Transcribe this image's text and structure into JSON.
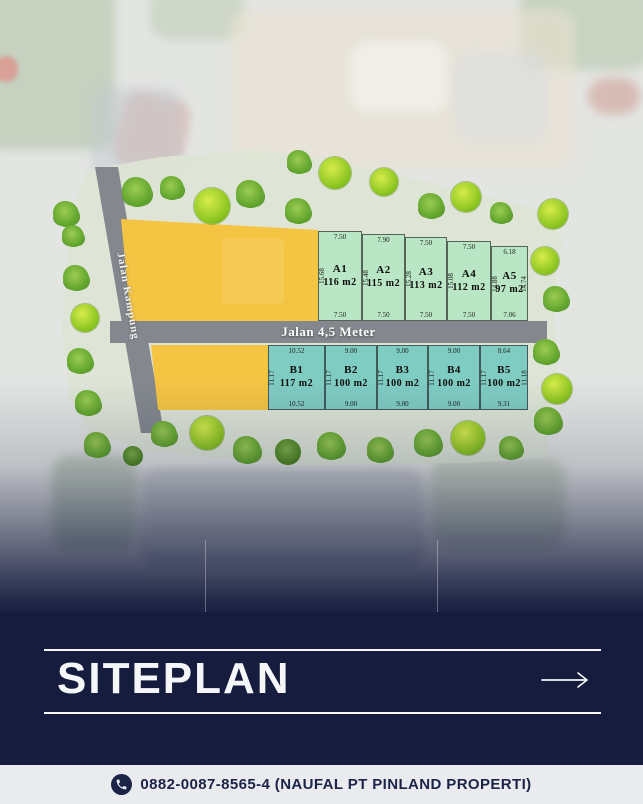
{
  "siteplan": {
    "road_vertical_label": "Jalan Kampung",
    "road_horizontal_label": "Jalan 4,5 Meter",
    "row_a": [
      {
        "id": "A1",
        "area": "116 m2",
        "top": "7.50",
        "bottom": "7.50",
        "side": "15.68"
      },
      {
        "id": "A2",
        "area": "115 m2",
        "top": "7.90",
        "bottom": "7.50",
        "side": "15.48"
      },
      {
        "id": "A3",
        "area": "113 m2",
        "top": "7.50",
        "bottom": "7.50",
        "side": "15.28"
      },
      {
        "id": "A4",
        "area": "112 m2",
        "top": "7.50",
        "bottom": "7.50",
        "side": "15.08"
      },
      {
        "id": "A5",
        "area": "97 m2",
        "top": "6.18",
        "bottom": "7.06",
        "side": "14.88",
        "side_right": "14.74"
      }
    ],
    "row_b": [
      {
        "id": "B1",
        "area": "117 m2",
        "top": "10.52",
        "bottom": "10.52",
        "side": "11.17"
      },
      {
        "id": "B2",
        "area": "100 m2",
        "top": "9.00",
        "bottom": "9.00",
        "side": "11.17"
      },
      {
        "id": "B3",
        "area": "100 m2",
        "top": "9.00",
        "bottom": "9.00",
        "side": "11.17"
      },
      {
        "id": "B4",
        "area": "100 m2",
        "top": "9.00",
        "bottom": "9.00",
        "side": "11.17"
      },
      {
        "id": "B5",
        "area": "100 m2",
        "top": "8.64",
        "bottom": "9.31",
        "side": "11.17",
        "side_right": "11.18"
      }
    ],
    "trees": [
      {
        "x": 66,
        "y": 214,
        "d": 26,
        "v": "m"
      },
      {
        "x": 137,
        "y": 192,
        "d": 30,
        "v": "m"
      },
      {
        "x": 172,
        "y": 188,
        "d": 24,
        "v": "m"
      },
      {
        "x": 212,
        "y": 206,
        "d": 36,
        "v": "b"
      },
      {
        "x": 250,
        "y": 194,
        "d": 28,
        "v": "m"
      },
      {
        "x": 299,
        "y": 162,
        "d": 24,
        "v": "m"
      },
      {
        "x": 298,
        "y": 211,
        "d": 26,
        "v": "m"
      },
      {
        "x": 335,
        "y": 173,
        "d": 32,
        "v": "b"
      },
      {
        "x": 384,
        "y": 182,
        "d": 28,
        "v": "b"
      },
      {
        "x": 431,
        "y": 206,
        "d": 26,
        "v": "m"
      },
      {
        "x": 466,
        "y": 197,
        "d": 30,
        "v": "b"
      },
      {
        "x": 501,
        "y": 213,
        "d": 22,
        "v": "m"
      },
      {
        "x": 553,
        "y": 214,
        "d": 30,
        "v": "b"
      },
      {
        "x": 545,
        "y": 261,
        "d": 28,
        "v": "b"
      },
      {
        "x": 556,
        "y": 299,
        "d": 26,
        "v": "m"
      },
      {
        "x": 546,
        "y": 352,
        "d": 26,
        "v": "m"
      },
      {
        "x": 557,
        "y": 389,
        "d": 30,
        "v": "b"
      },
      {
        "x": 97,
        "y": 445,
        "d": 26,
        "v": "m"
      },
      {
        "x": 133,
        "y": 456,
        "d": 20,
        "v": "k"
      },
      {
        "x": 164,
        "y": 434,
        "d": 26,
        "v": "m"
      },
      {
        "x": 207,
        "y": 433,
        "d": 34,
        "v": "b"
      },
      {
        "x": 247,
        "y": 450,
        "d": 28,
        "v": "m"
      },
      {
        "x": 288,
        "y": 452,
        "d": 26,
        "v": "k"
      },
      {
        "x": 331,
        "y": 446,
        "d": 28,
        "v": "m"
      },
      {
        "x": 380,
        "y": 450,
        "d": 26,
        "v": "m"
      },
      {
        "x": 428,
        "y": 443,
        "d": 28,
        "v": "m"
      },
      {
        "x": 468,
        "y": 438,
        "d": 34,
        "v": "b"
      },
      {
        "x": 511,
        "y": 448,
        "d": 24,
        "v": "m"
      },
      {
        "x": 548,
        "y": 421,
        "d": 28,
        "v": "m"
      },
      {
        "x": 73,
        "y": 236,
        "d": 22,
        "v": "m"
      },
      {
        "x": 76,
        "y": 278,
        "d": 26,
        "v": "m"
      },
      {
        "x": 85,
        "y": 318,
        "d": 28,
        "v": "b"
      },
      {
        "x": 80,
        "y": 361,
        "d": 26,
        "v": "m"
      },
      {
        "x": 88,
        "y": 403,
        "d": 26,
        "v": "m"
      }
    ]
  },
  "footer": {
    "title": "SITEPLAN",
    "arrow_icon": "arrow-right"
  },
  "contact": {
    "phone_icon": "phone",
    "text": "0882-0087-8565-4 (NAUFAL PT PINLAND PROPERTI)"
  },
  "colors": {
    "navy": "#151c3e",
    "plot_a": "#b9e6c4",
    "plot_b": "#7fccc3",
    "block_yellow": "#f4c443",
    "road_gray": "#84888e",
    "bar_bg": "#e9ebee"
  }
}
